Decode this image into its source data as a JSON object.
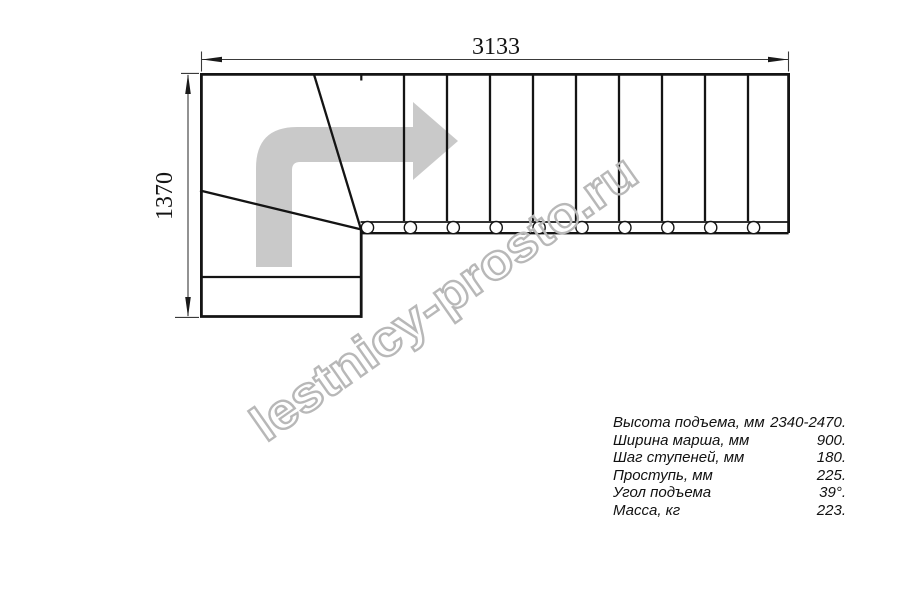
{
  "dimensions": {
    "width_label": "3133",
    "height_label": "1370"
  },
  "watermark": {
    "text": "lestnicy-prosto.ru"
  },
  "specs": {
    "rows": [
      {
        "label": "Высота подъема, мм",
        "value": "2340-2470."
      },
      {
        "label": "Ширина марша, мм",
        "value": "900."
      },
      {
        "label": "Шаг ступеней, мм",
        "value": "180."
      },
      {
        "label": "Проступь, мм",
        "value": "225."
      },
      {
        "label": "Угол подъема",
        "value": "39°."
      },
      {
        "label": "Масса, кг",
        "value": "223."
      }
    ]
  },
  "colors": {
    "line": "#141414",
    "dimension": "#3a3a3a",
    "arrow_fill": "#c9c9c9",
    "watermark_stroke": "#b8b8b8"
  }
}
